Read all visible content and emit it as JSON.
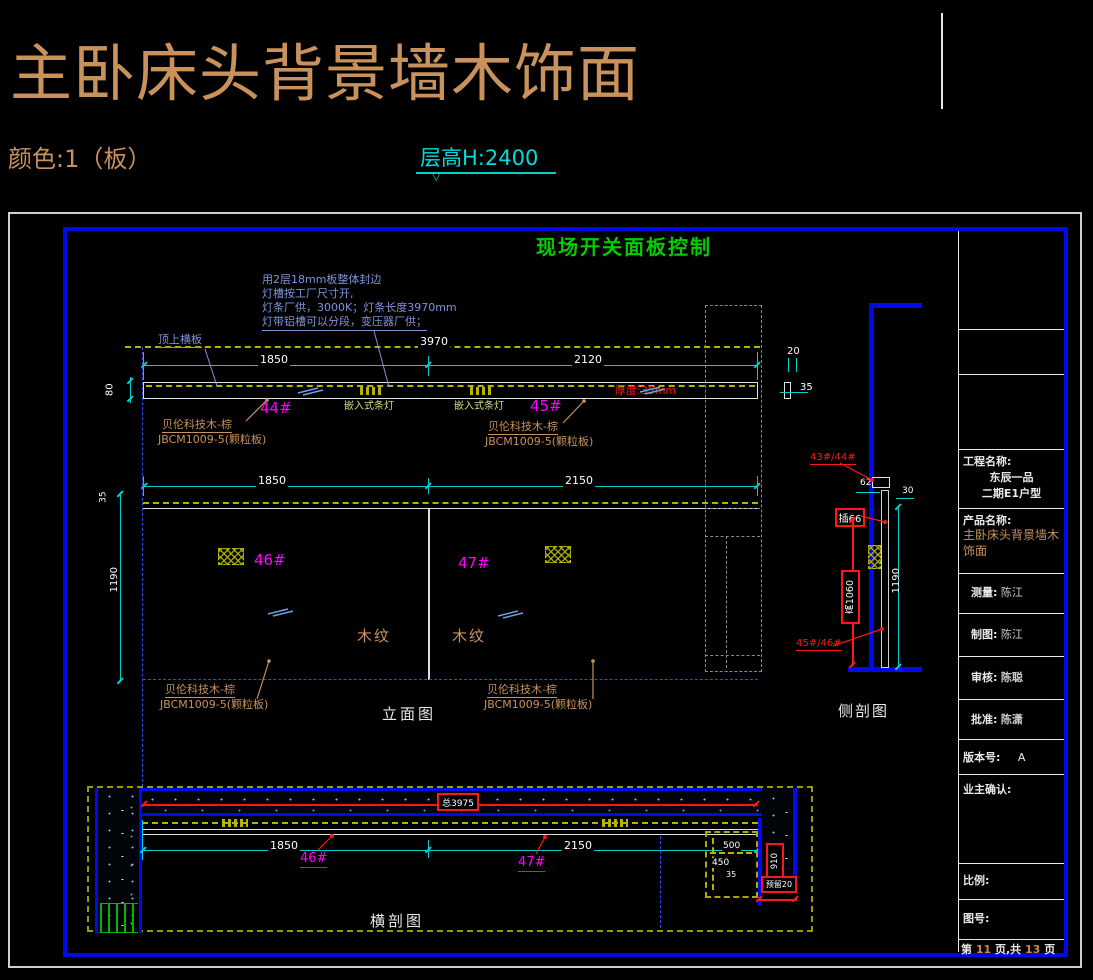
{
  "header": {
    "title": "主卧床头背景墙木饰面",
    "color_note": "颜色:1（板）",
    "floor_height": "层高H:2400",
    "triangle": "▽"
  },
  "frame": {
    "control_title": "现场开关面板控制"
  },
  "notes": {
    "lamp_line1": "用2层18mm板整体封边",
    "lamp_line2": "灯槽按工厂尺寸开,",
    "lamp_line3": "灯条厂供，3000K；灯条长度3970mm",
    "lamp_line4": "灯带铝槽可以分段，变压器厂供；",
    "top_board": "顶上横板",
    "material1": "贝伦科技木-棕",
    "material2": "JBCM1009-5(颗粒板)",
    "recessed_lamp": "嵌入式条灯",
    "thickness": "厚度:35mm",
    "wood_grain": "木纹"
  },
  "elevation": {
    "label": "立面图",
    "dim_3970": "3970",
    "dim_top_left": "1850",
    "dim_top_right": "2120",
    "dim_mid_left": "1850",
    "dim_mid_right": "2150",
    "dim_80": "80",
    "dim_35": "35",
    "dim_1190": "1190",
    "tag_44": "44#",
    "tag_45": "45#",
    "tag_46": "46#",
    "tag_47": "47#",
    "detail_dim_20": "20",
    "detail_dim_35": "35"
  },
  "side_section": {
    "label": "侧剖图",
    "ref_top": "43#/44#",
    "ref_bottom": "45#/46#",
    "socket": "插66",
    "height_box": "高1060",
    "dim_62": "62",
    "dim_30": "30",
    "dim_1190": "1190"
  },
  "cross_section": {
    "label": "横剖图",
    "total": "总3975",
    "dim_left": "1850",
    "dim_right": "2150",
    "tag_46": "46#",
    "tag_47": "47#",
    "niche_w": "500",
    "niche_h": "450",
    "dim_35": "35",
    "gap_v": "910",
    "gap_h": "预留20"
  },
  "titleblock": {
    "project_label": "工程名称:",
    "project_line1": "东辰一品",
    "project_line2": "二期E1户型",
    "product_label": "产品名称:",
    "product_value": "主卧床头背景墙木饰面",
    "measure_label": "测量:",
    "measure_value": "陈江",
    "draft_label": "制图:",
    "draft_value": "陈江",
    "review_label": "审核:",
    "review_value": "陈聪",
    "approve_label": "批准:",
    "approve_value": "陈潇",
    "version_label": "版本号:",
    "version_value": "A",
    "owner_label": "业主确认:",
    "scale_label": "比例:",
    "figure_label": "图号:",
    "page_prefix": "第",
    "page_current": "11",
    "page_mid": "页,共",
    "page_total": "13",
    "page_suffix": "页"
  }
}
